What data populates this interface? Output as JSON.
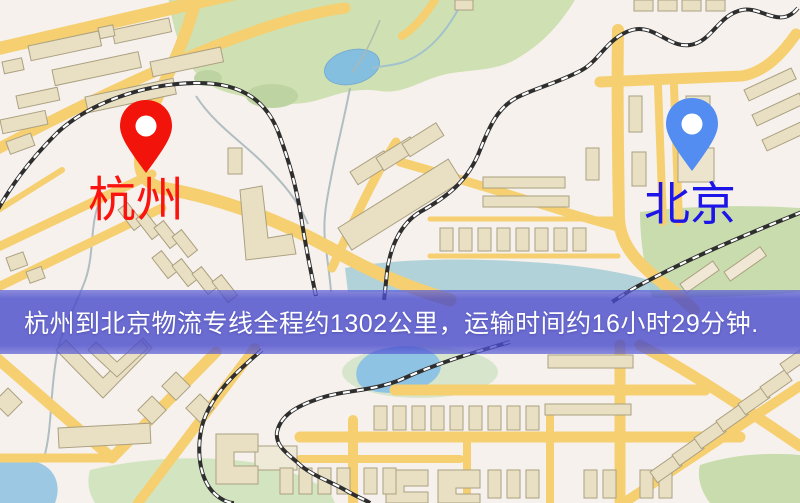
{
  "map": {
    "type": "street-map",
    "banner": {
      "text": "杭州到北京物流专线全程约1302公里，运输时间约16小时29分钟.",
      "bg_color": "#484acb",
      "bg_opacity": "0.78",
      "text_color": "#ffffff"
    },
    "markers": [
      {
        "id": "origin",
        "icon": "map-pin",
        "label": "杭州",
        "pin_color": "#f2140a",
        "label_color": "#fb1310"
      },
      {
        "id": "destination",
        "icon": "map-pin",
        "label": "北京",
        "pin_color": "#538df1",
        "label_color": "#1d14e8"
      }
    ],
    "route": {
      "origin": "杭州",
      "destination": "北京",
      "distance_km": "1302",
      "duration": "16小时29分钟"
    },
    "colors": {
      "background": "#f6f1ec",
      "road": "#f5cf70",
      "park": "#cfe0b2",
      "water": "#8fc3e3",
      "building": "#e9e0c4",
      "building_outline": "#aba081",
      "railway": "#2e2e2e"
    }
  }
}
